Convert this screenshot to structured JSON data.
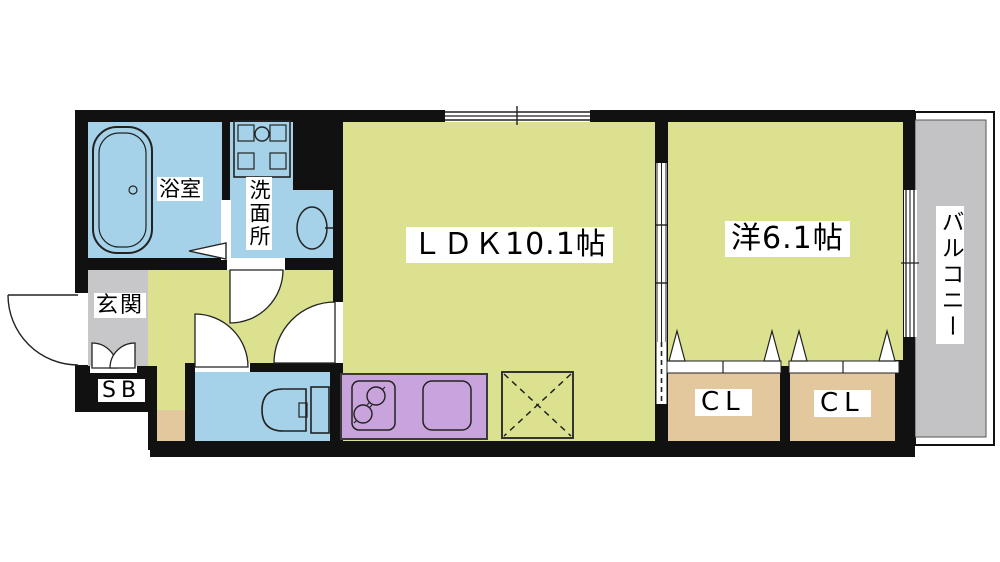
{
  "floor_plan": {
    "type": "apartment-floor-plan-1LDK",
    "rooms": {
      "bathroom": {
        "label": "浴室"
      },
      "washroom": {
        "label": "洗面所"
      },
      "entrance": {
        "label": "玄関"
      },
      "shoe_box": {
        "label": "SB"
      },
      "ldk": {
        "label": "ＬＤＫ10.1帖",
        "size_jo": 10.1
      },
      "western_room": {
        "label": "洋6.1帖",
        "size_jo": 6.1
      },
      "closet_left": {
        "label": "CL"
      },
      "closet_right": {
        "label": "CL"
      },
      "balcony": {
        "label": "バルコニー"
      }
    },
    "fixtures": [
      "bathtub",
      "washing-machine-space",
      "wash-basin",
      "toilet",
      "gas-stove",
      "kitchen-sink",
      "refrigerator-space",
      "entrance-door",
      "sliding-door",
      "windows",
      "closet-folding-doors"
    ],
    "colors": {
      "floor_green": "#dce18f",
      "water_blue": "#a5d2e8",
      "kitchen_purple": "#c9a3dc",
      "storage_tan": "#e3c89e",
      "entrance_gray": "#c7c7c9",
      "balcony_gray": "#c3c3c5",
      "wall_black": "#111111"
    }
  }
}
